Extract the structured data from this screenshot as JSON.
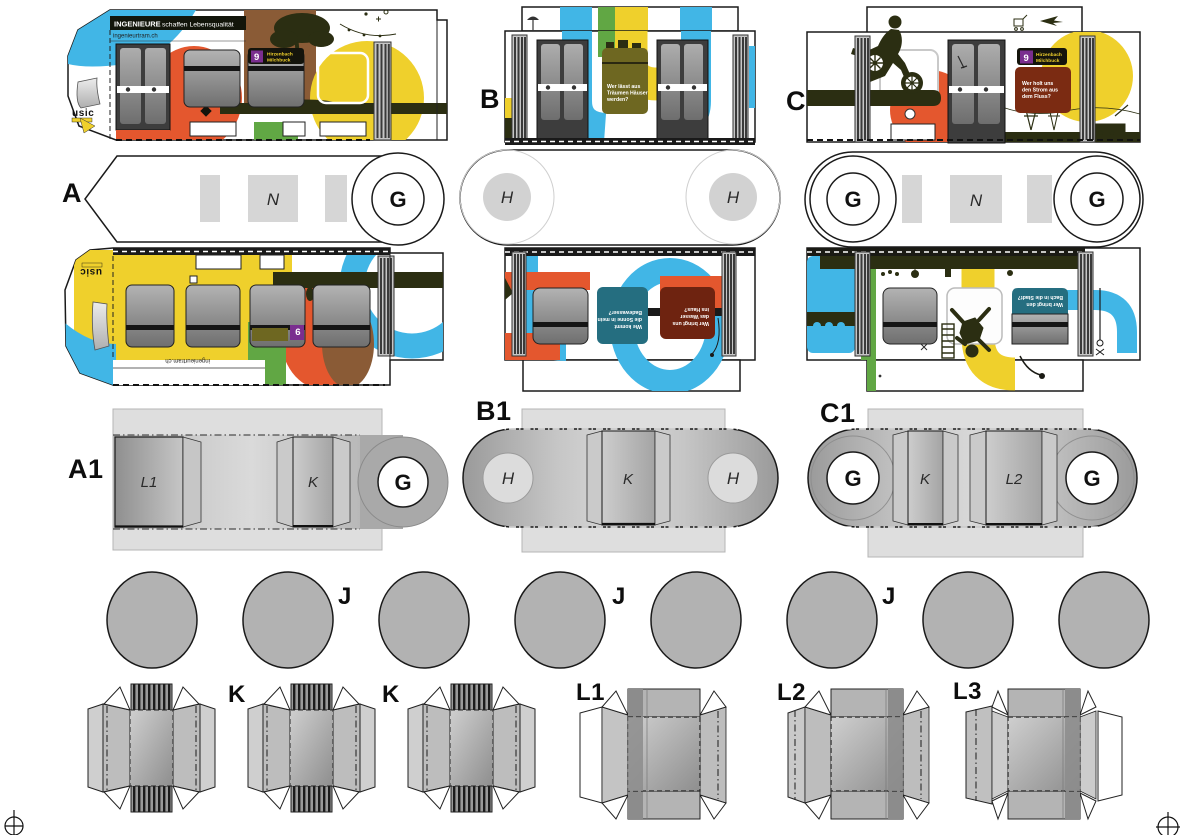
{
  "campaign": {
    "slogan_bold": "INGENIEURE",
    "slogan_rest": "schaffen Lebensqualität",
    "website": "ingenieurtram.ch",
    "logo": "usic"
  },
  "route_sign": {
    "line": "9",
    "dest1": "Hirzenbach",
    "dest2": "Milchbuck"
  },
  "panels": {
    "houses": {
      "l1": "Wer lässt aus",
      "l2": "Träumen Häuser",
      "l3": "werden?"
    },
    "power": {
      "l1": "Wer holt uns",
      "l2": "den Strom aus",
      "l3": "dem Fluss?"
    },
    "bath": {
      "l1": "Wie kommt",
      "l2": "die Sonne in mein",
      "l3": "Badewasser?"
    },
    "water": {
      "l1": "Wer bringt uns",
      "l2": "das Wasser",
      "l3": "ins Haus?"
    },
    "creek": {
      "l1": "Wer bringt den",
      "l2": "Bach in die Stadt?"
    }
  },
  "labels": {
    "a": "A",
    "b": "B",
    "c": "C",
    "a1": "A1",
    "b1": "B1",
    "c1": "C1",
    "g": "G",
    "h": "H",
    "n": "N",
    "j": "J",
    "k": "K",
    "l1": "L1",
    "l2": "L2",
    "l3": "L3"
  },
  "colors": {
    "blue": "#41B6E6",
    "orange": "#E4572E",
    "yellow": "#EFD02C",
    "green": "#61A744",
    "olive": "#2B2E12",
    "olive_panel": "#6E6721",
    "purple": "#7A2E8F",
    "maroon": "#7B2B12",
    "teal": "#256E80",
    "brown": "#8A5B36",
    "part_gray": "#DEDEDE"
  }
}
